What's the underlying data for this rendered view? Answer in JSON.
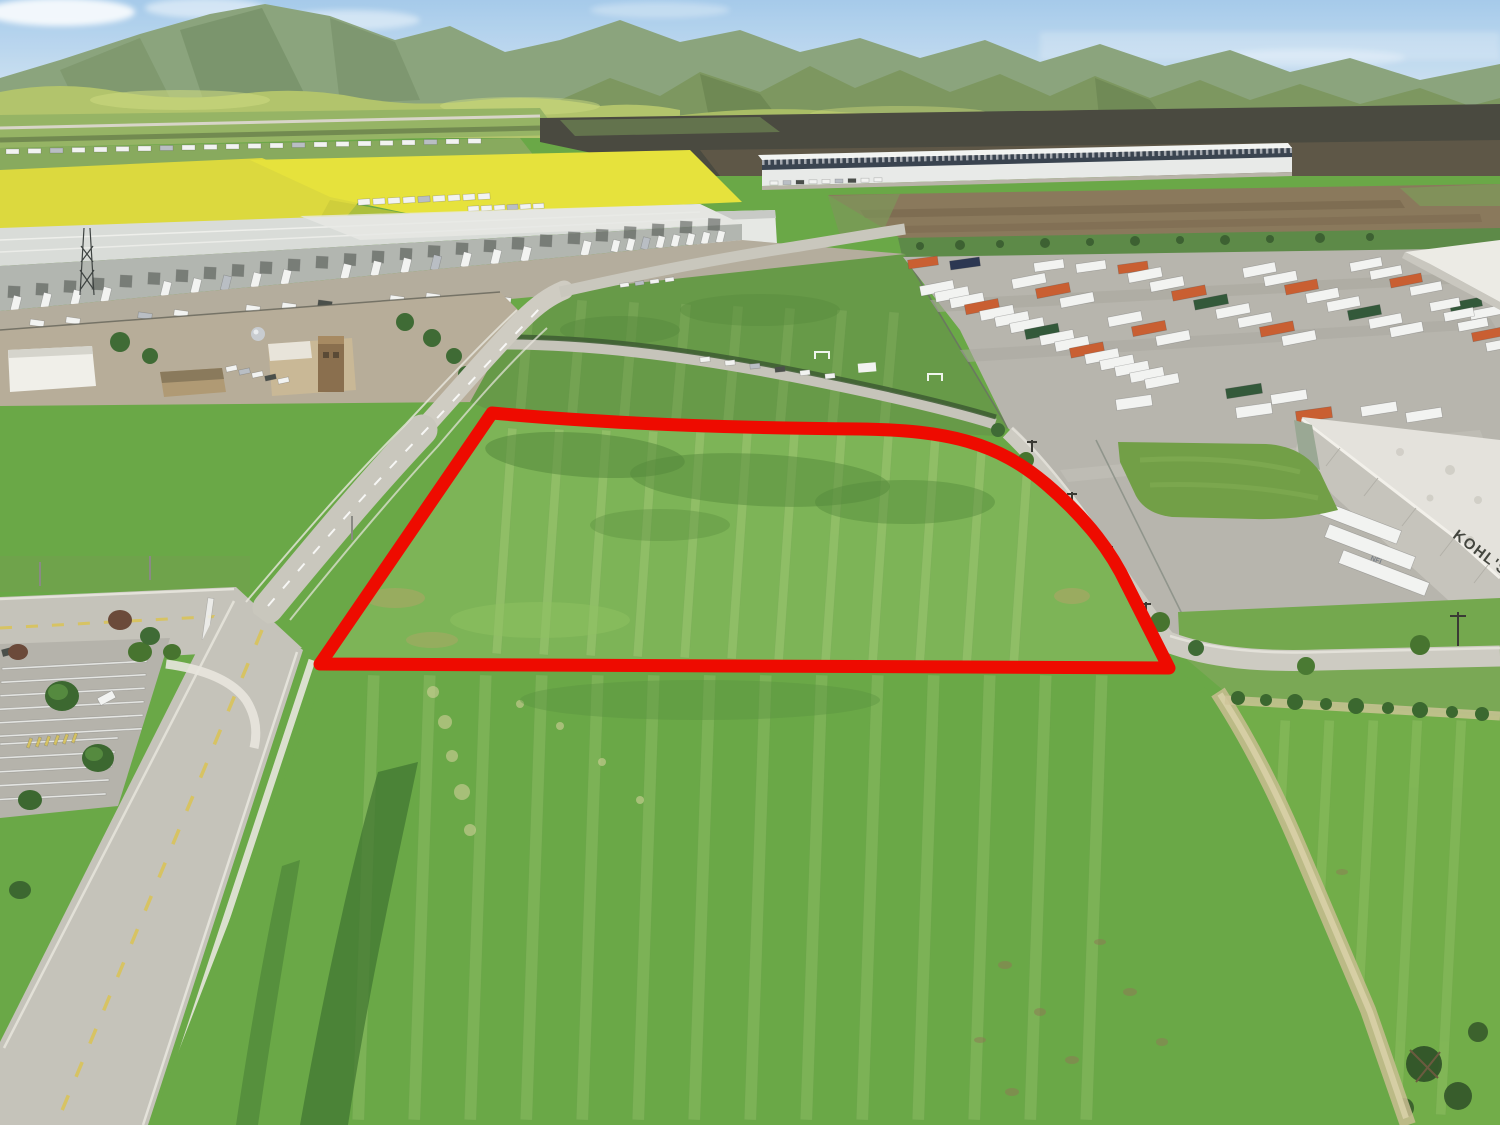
{
  "scene": {
    "type": "aerial-drone-photograph",
    "subject": "Vacant commercial land parcel outlined in red, bordered by a road, industrial distribution warehouses, a trailer storage yard and green fields with mountains behind",
    "outline_color": "#ee0b00"
  },
  "labels": {
    "kohls_sign": "KOHL'S",
    "nfi_logo": "NFI"
  },
  "palette": {
    "sky_top": "#9cc5e8",
    "sky_horizon": "#ddeaf4",
    "mountain_far": "#7e9a6f",
    "mountain_mid": "#7d9760",
    "foothills": "#b2c46c",
    "flower_field": "#e3df3a",
    "grass_parcel": "#7db457",
    "grass_mid": "#679a48",
    "grass_foreground": "#6aa847",
    "asphalt": "#b9b7af",
    "concrete": "#cbc9c1",
    "dirt_field": "#8a795c",
    "roof_white": "#e6e7e3",
    "red_outline": "#ee0b00"
  },
  "palette_map": {
    "w": "#f2f3f1",
    "o": "#c95f32",
    "g": "#33593a",
    "b": "#2c3752",
    "s": "#b9bec4",
    "d": "#4a4f4a",
    "t": "#e9f0b2",
    "y": "#d8c35a"
  },
  "scatter": {
    "valley_rv": [
      {
        "n": 22,
        "x": 6,
        "y": 149,
        "dx": 22,
        "dy": -0.5,
        "w": 13,
        "h": 5,
        "rot": 0,
        "p": "wwswwwwswwwwwswwwwwsww"
      }
    ],
    "rv_back": [
      {
        "n": 9,
        "x": 358,
        "y": 199,
        "dx": 15,
        "dy": -0.7,
        "w": 12,
        "h": 6,
        "rot": -4,
        "p": "wwwwswwww"
      },
      {
        "n": 6,
        "x": 468,
        "y": 206,
        "dx": 13,
        "dy": -0.5,
        "w": 11,
        "h": 5,
        "rot": -4,
        "p": "wwwsww"
      }
    ],
    "wh_doors": [
      {
        "n": 26,
        "x": 8,
        "y": 286,
        "dx": 28,
        "dy": -2.7,
        "w": 12,
        "h": 12,
        "rot": 3,
        "p": "dddddddddddddddddddddddddd",
        "op": 0.55
      }
    ],
    "wh_docks": [
      {
        "n": 20,
        "x": 12,
        "y": 296,
        "dx": 30,
        "dy": -2.9,
        "w": 8,
        "h": 15,
        "rot": 14,
        "p": "wwww.wwsww.wwwswww.w"
      },
      {
        "n": 8,
        "x": 612,
        "y": 240,
        "dx": 15,
        "dy": -1.3,
        "w": 7,
        "h": 12,
        "rot": 14,
        "p": "wwswwwww"
      }
    ],
    "apron_trucks": [
      {
        "n": 12,
        "x": 30,
        "y": 320,
        "dx": 36,
        "dy": -2.4,
        "w": 14,
        "h": 6,
        "rot": 8,
        "p": "ww.sw.wwd.ww"
      },
      {
        "n": 6,
        "x": 498,
        "y": 297,
        "dx": 30,
        "dy": -2,
        "w": 13,
        "h": 6,
        "rot": 8,
        "p": "w.wsww"
      }
    ],
    "dist_cars": [
      {
        "n": 9,
        "x": 770,
        "y": 181,
        "dx": 13,
        "dy": -0.4,
        "w": 8,
        "h": 4,
        "rot": 0,
        "p": "wsdwwsdww"
      }
    ],
    "road_cars_upper": [
      {
        "n": 4,
        "x": 620,
        "y": 283,
        "dx": 15,
        "dy": -1.8,
        "w": 9,
        "h": 4,
        "rot": -8,
        "p": "wsww"
      }
    ],
    "road_cars_mid": [
      {
        "n": 6,
        "x": 700,
        "y": 357,
        "dx": 25,
        "dy": 3.3,
        "w": 10,
        "h": 5,
        "rot": -6,
        "p": "wwsdww"
      }
    ],
    "yard_rows": [
      {
        "n": 6,
        "x": 908,
        "y": 258,
        "dx": 42,
        "dy": 1,
        "w": 30,
        "h": 9,
        "rot": -8,
        "p": "ob.wwo"
      },
      {
        "n": 16,
        "x": 920,
        "y": 283,
        "dx": 15,
        "dy": 6.2,
        "w": 34,
        "h": 10,
        "rot": -11,
        "p": "wwwowwwgwwowwwww"
      },
      {
        "n": 7,
        "x": 1012,
        "y": 276,
        "dx": 24,
        "dy": 9.5,
        "w": 34,
        "h": 10,
        "rot": -11,
        "p": "wow.wow"
      },
      {
        "n": 8,
        "x": 1128,
        "y": 270,
        "dx": 22,
        "dy": 9,
        "w": 34,
        "h": 10,
        "rot": -11,
        "p": "wwogwwow"
      },
      {
        "n": 8,
        "x": 1243,
        "y": 265,
        "dx": 21,
        "dy": 8.5,
        "w": 33,
        "h": 10,
        "rot": -11,
        "p": "wwowwgww"
      },
      {
        "n": 7,
        "x": 1350,
        "y": 260,
        "dx": 20,
        "dy": 8,
        "w": 32,
        "h": 9,
        "rot": -11,
        "p": "wwow.gw"
      },
      {
        "n": 5,
        "x": 1430,
        "y": 300,
        "dx": 14,
        "dy": 10,
        "w": 30,
        "h": 9,
        "rot": -11,
        "p": "wwwow"
      },
      {
        "n": 5,
        "x": 1226,
        "y": 386,
        "dx": 45,
        "dy": 6,
        "w": 36,
        "h": 10,
        "rot": -9,
        "p": "gw.ww"
      },
      {
        "n": 4,
        "x": 1116,
        "y": 397,
        "dx": 60,
        "dy": 4,
        "w": 36,
        "h": 11,
        "rot": -8,
        "p": "w.wo"
      }
    ],
    "kohls_docks": [
      {
        "n": 3,
        "x": 1310,
        "y": 514,
        "dx": 14,
        "dy": 26,
        "w": 92,
        "h": 14,
        "rot": 21,
        "p": "w"
      }
    ],
    "fire_cars": [
      {
        "n": 5,
        "x": 226,
        "y": 366,
        "dx": 13,
        "dy": 3,
        "w": 11,
        "h": 5,
        "rot": -12,
        "p": "wswdw"
      }
    ],
    "lot_stripes": [
      {
        "n": 6,
        "x": 2,
        "y": 664,
        "dx": -1,
        "dy": 13.5,
        "w": 145,
        "h": 2,
        "rot": -3,
        "p": "w",
        "op": 0.8
      },
      {
        "n": 5,
        "x": 0,
        "y": 740,
        "dx": -3,
        "dy": 14,
        "w": 118,
        "h": 2,
        "rot": -3,
        "p": "w",
        "op": 0.8
      }
    ],
    "lot_crosswalk": [
      {
        "n": 6,
        "x": 28,
        "y": 738,
        "dx": 9,
        "dy": -1,
        "w": 3,
        "h": 10,
        "rot": 20,
        "p": "y",
        "op": 0.9
      }
    ],
    "lot_cars": [
      {
        "n": 1,
        "x": 98,
        "y": 694,
        "dx": 0,
        "dy": 0,
        "w": 17,
        "h": 8,
        "rot": -28,
        "p": "w"
      },
      {
        "n": 1,
        "x": 2,
        "y": 648,
        "dx": 0,
        "dy": 0,
        "w": 14,
        "h": 7,
        "rot": -15,
        "p": "d"
      }
    ],
    "crosswalk": [
      {
        "n": 2,
        "x": 205,
        "y": 598,
        "dx": 17,
        "dy": 11,
        "w": 6,
        "h": 42,
        "rot": 8,
        "p": "w",
        "op": 0.85
      }
    ],
    "parcel_streaks": [
      {
        "n": 12,
        "x": 500,
        "y": 428,
        "dx": 47,
        "dy": 1,
        "w": 9,
        "h": 226,
        "rot": 4,
        "p": "t",
        "op": 0.17
      }
    ],
    "fg_streaks": [
      {
        "n": 14,
        "x": 360,
        "y": 675,
        "dx": 56,
        "dy": 0,
        "w": 12,
        "h": 445,
        "rot": 2,
        "p": "t",
        "op": 0.14
      }
    ],
    "rf_streaks": [
      {
        "n": 5,
        "x": 1270,
        "y": 720,
        "dx": 44,
        "dy": 0,
        "w": 10,
        "h": 395,
        "rot": 3,
        "p": "t",
        "op": 0.12
      }
    ],
    "mf_streaks": [
      {
        "n": 8,
        "x": 520,
        "y": 298,
        "dx": 52,
        "dy": 2,
        "w": 10,
        "h": 118,
        "rot": 5,
        "p": "t",
        "op": 0.1
      }
    ]
  }
}
